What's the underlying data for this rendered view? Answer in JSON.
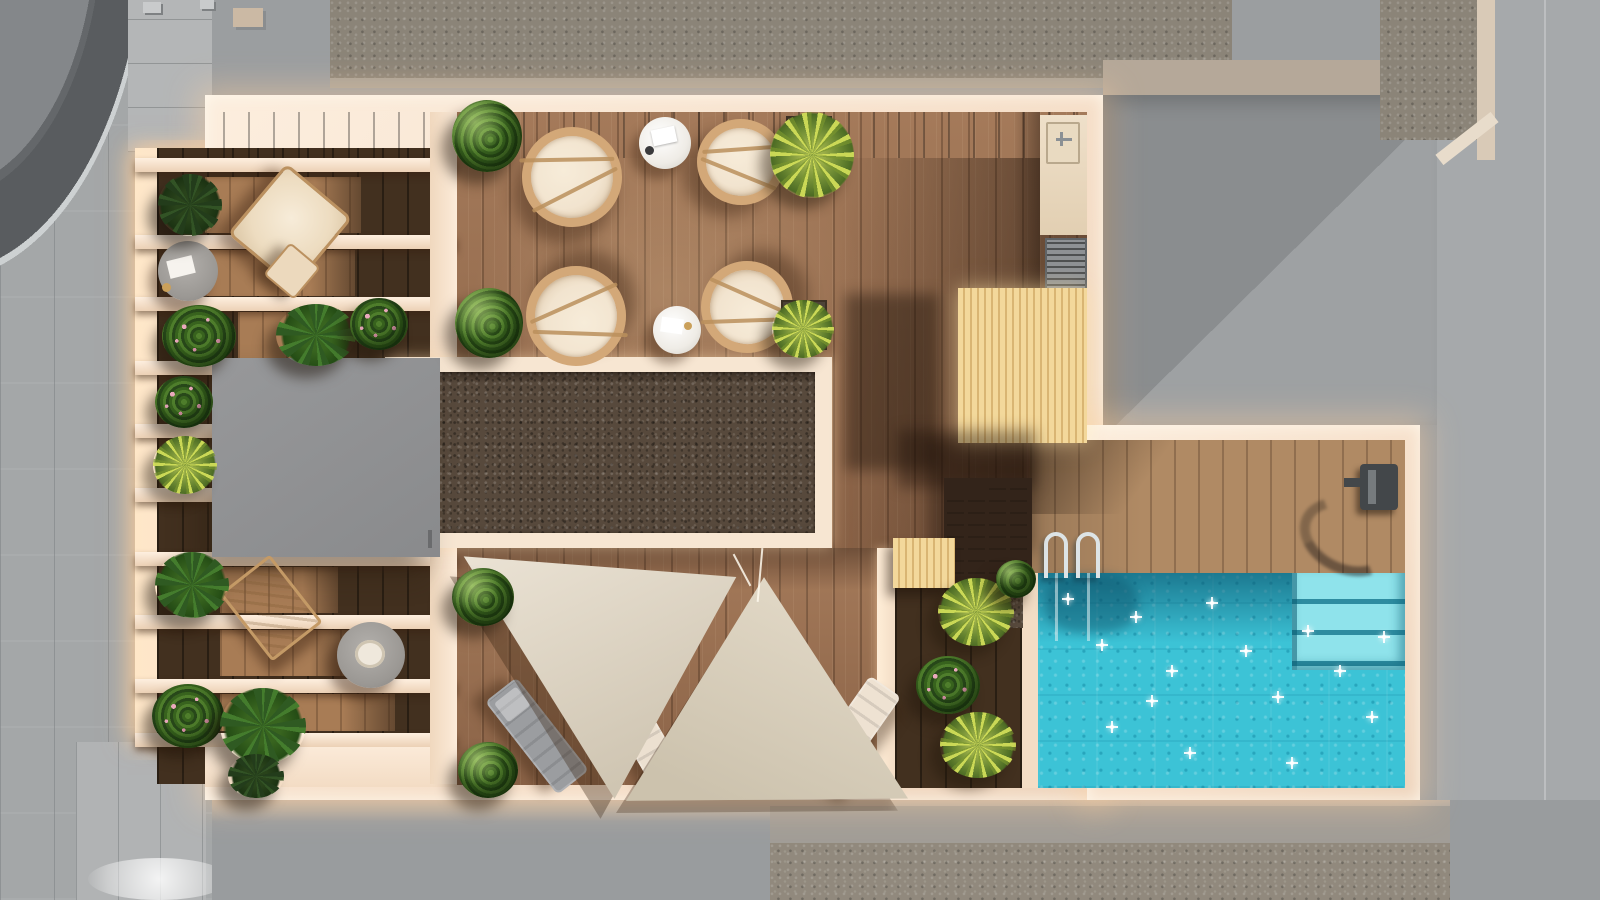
{
  "meta": {
    "title": "Rooftop terrace with pool — top-down 3D architectural render",
    "render_type": "aerial plan view, afternoon sun from upper right"
  },
  "palette": {
    "roof_gray": "#9b9ea0",
    "street_gray": "#a4a7a8",
    "courtyard_gray": "#8a8d8f",
    "gravel_roof": "#8b8478",
    "gravel_dark": "#57493c",
    "wall_cream": "#f6dfc9",
    "wall_glow": "#ffd9a8",
    "wood_deck": "#9a6e4f",
    "wood_deck_light": "#b08a64",
    "wood_dark": "#42301f",
    "wood_slat_light": "#f3d89b",
    "pool_water": "#3cc3d6",
    "pool_shadow": "#0c6d92",
    "pool_step": "#8fe3eb",
    "sail_beige": "#e2d9c9",
    "cushion_cream": "#f2e4cf",
    "rattan_tan": "#d3a878",
    "lounger_gray": "#9b9da0",
    "block_gray": "#8e8f91",
    "plant_green": "#3a6420",
    "palm_green": "#c0d45c",
    "flower_pink": "#e3a0b5"
  },
  "scene": {
    "surroundings": {
      "left": "street with paved sidewalk and curved canopy roof",
      "top": "neighboring flat roof with gravel field and vents",
      "right": "inner courtyard in shadow and side street",
      "bottom": "sidewalk and gravel roof of lower building"
    },
    "terrace_zones": [
      {
        "name": "pergola-lounge",
        "items": [
          "hanging-chair",
          "side-table",
          "folding-deck-chair",
          "low-table",
          "planting-rows"
        ]
      },
      {
        "name": "dining-deck",
        "items": [
          "wicker-chair x4",
          "round-table x2",
          "planter-box x2"
        ]
      },
      {
        "name": "outdoor-kitchen",
        "items": [
          "counter-with-sink",
          "ventilation-grille"
        ]
      },
      {
        "name": "timber-slat-canopy"
      },
      {
        "name": "gravel-skylight-band"
      },
      {
        "name": "roof-access-block"
      },
      {
        "name": "stairs-to-pool-deck",
        "steps": 4
      },
      {
        "name": "shade-sail-deck",
        "items": [
          "triangular-shade-sail x2",
          "sun-lounger x3"
        ]
      },
      {
        "name": "planting-strip",
        "items": [
          "yucca-palm x2",
          "flowering-shrub",
          "gravel-planter"
        ]
      },
      {
        "name": "pool-deck",
        "items": [
          "outdoor-shower"
        ]
      },
      {
        "name": "swimming-pool",
        "items": [
          "chrome-ladder",
          "underwater-corner-steps",
          "sun-sparkles"
        ]
      }
    ],
    "counts": {
      "wicker_chairs": 4,
      "round_tables": 2,
      "shade_sails": 2,
      "sun_loungers": 3,
      "plant_clusters": 20,
      "stair_steps": 4
    }
  }
}
